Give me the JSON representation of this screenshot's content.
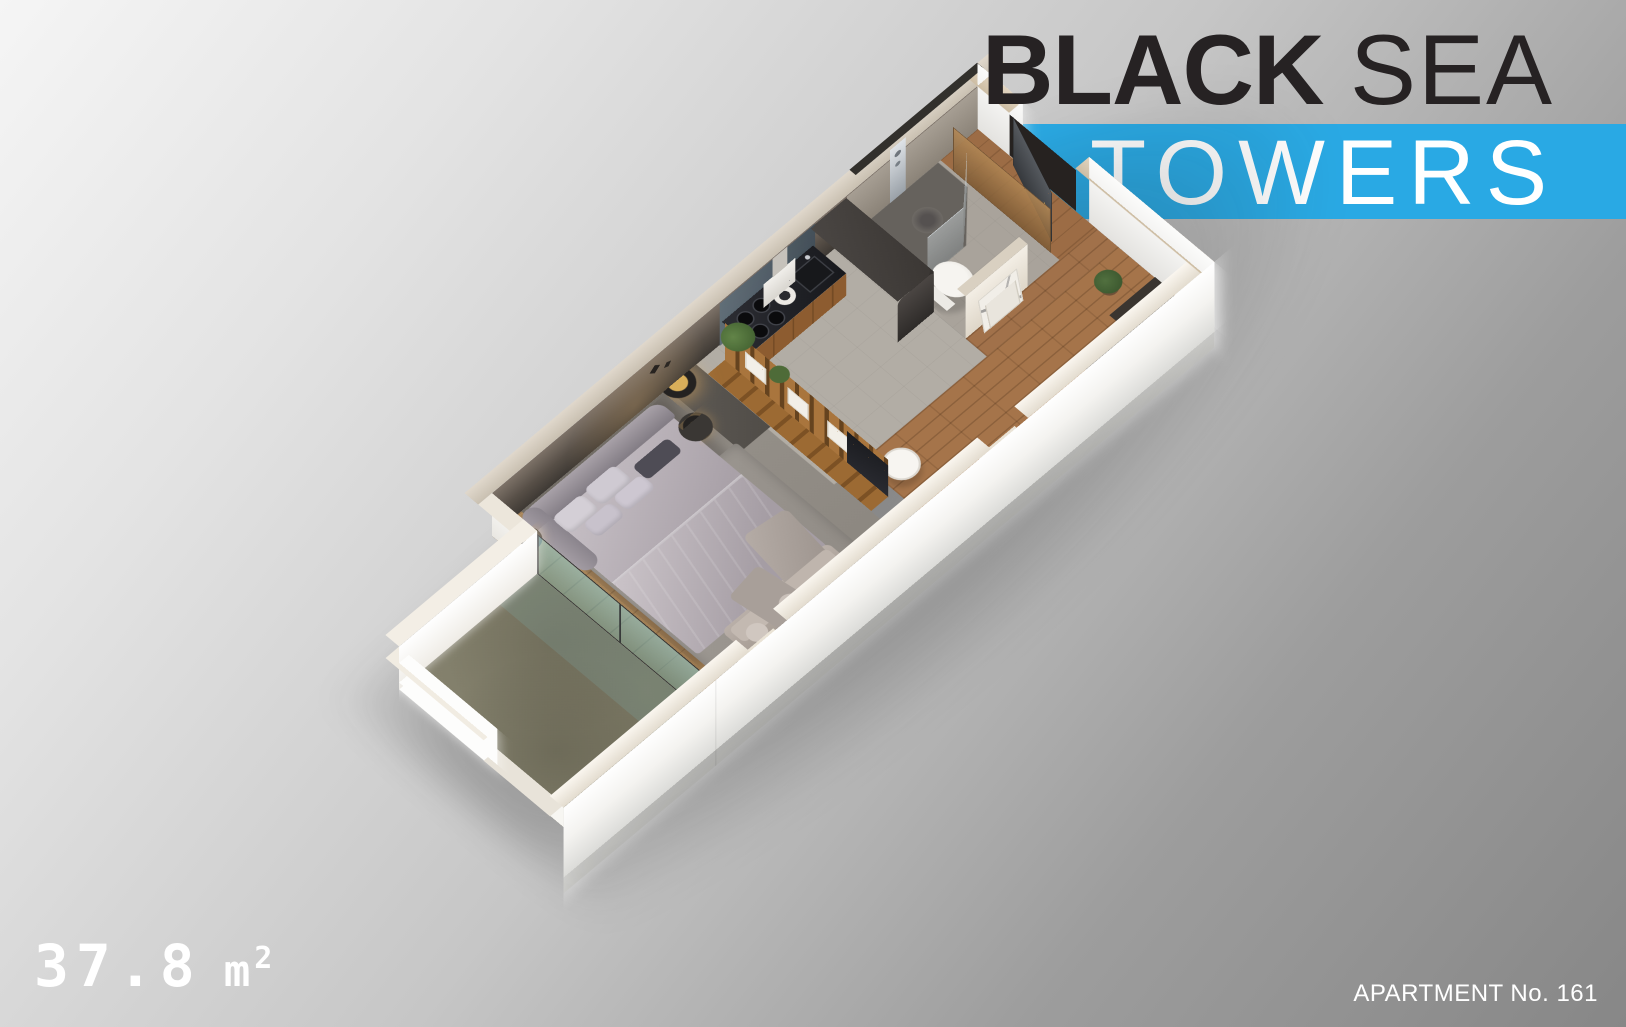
{
  "brand": {
    "title_bold": "BLACK",
    "title_light": "SEA",
    "banner_text": "TOWERS"
  },
  "footer": {
    "area_value": "37.8",
    "area_unit_base": "m",
    "area_unit_exp": "2",
    "apartment_label": "APARTMENT No. 161"
  },
  "colors": {
    "banner_blue": "#29a9e4",
    "logo_dark": "#262223",
    "text_white": "#ffffff",
    "background_light": "#f5f5f5",
    "background_dark": "#878787",
    "wall_white": "#ffffff",
    "wall_top_beige": "#d3c9ba",
    "inner_wall_dark": "#4a443e",
    "wood_floor": "#a5744a",
    "kitchen_tile": "#b2ada5",
    "balcony_floor": "#817e6f",
    "glass_teal": "#57b5c6",
    "bronze_glass": "#a87e4e",
    "entry_door_dark": "#45484d",
    "bed_gray": "#b6afb5",
    "counter_black": "#1c1d21",
    "lamp_gold": "#caa14f"
  }
}
